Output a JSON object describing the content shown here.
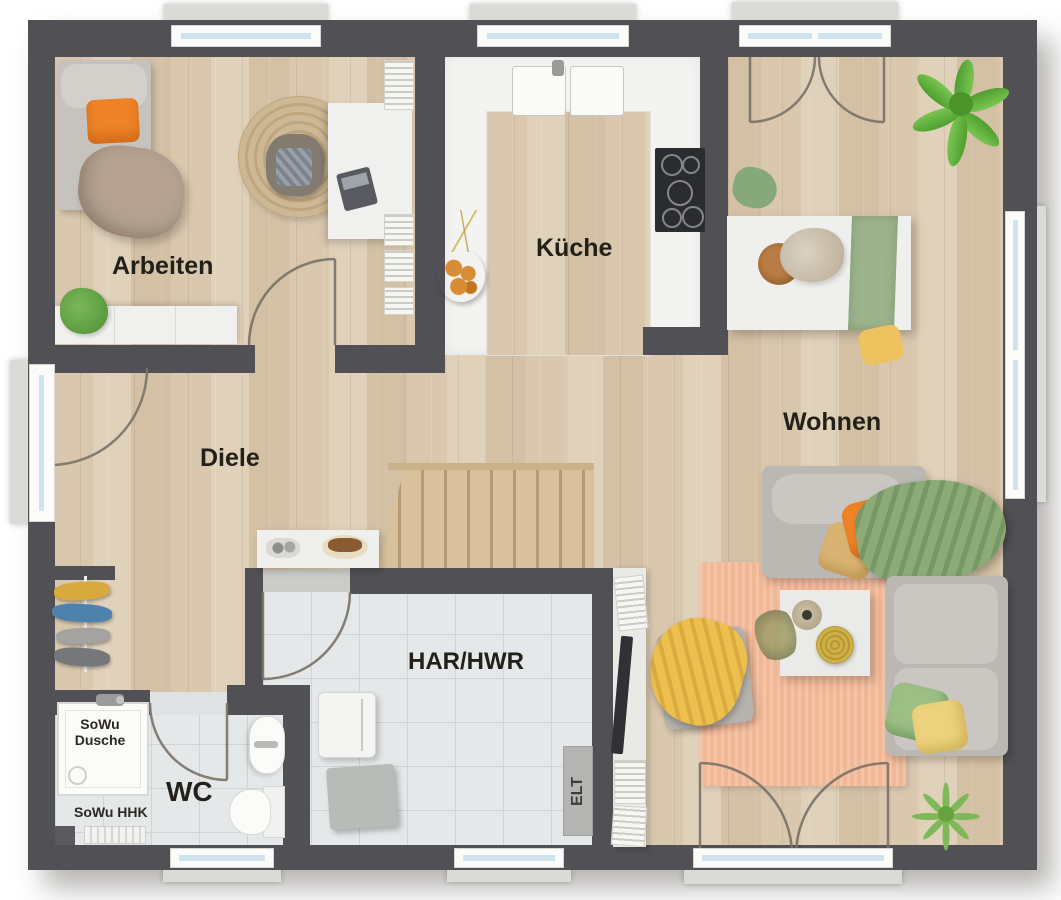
{
  "plan": {
    "type": "residential-floor-plan",
    "rooms": [
      {
        "id": "arbeiten",
        "label": "Arbeiten"
      },
      {
        "id": "kueche",
        "label": "Küche"
      },
      {
        "id": "wohnen",
        "label": "Wohnen"
      },
      {
        "id": "diele",
        "label": "Diele"
      },
      {
        "id": "har-hwr",
        "label": "HAR/HWR"
      },
      {
        "id": "wc",
        "label": "WC"
      }
    ],
    "annotations": {
      "shower_line1": "SoWu",
      "shower_line2": "Dusche",
      "heater": "SoWu HHK",
      "electrical": "ELT"
    },
    "palette": {
      "wall": "#515155",
      "wood_floor": "#d9c7ae",
      "tile_floor": "#e5e8e9",
      "kitchen_floor": "#f3f3f1",
      "stair_wood": "#d5bd97",
      "rug_peach": "#f2b795",
      "accent_orange": "#ee8327",
      "accent_yellow": "#eeb757",
      "accent_green": "#8cab77",
      "plant_green": "#6ab544",
      "window_glass": "#cfe3ee",
      "door_arc": "#7a7268",
      "label_text": "#232019"
    },
    "objects": [
      "bed",
      "round-rug",
      "desk",
      "desk-chair",
      "bookshelf",
      "sideboard",
      "houseplant",
      "kitchen-sink",
      "cooktop",
      "fruit-bowl",
      "dining-table",
      "table-runner",
      "dining-chairs",
      "fern-plant",
      "sofa",
      "chaise",
      "coffee-table",
      "ottoman",
      "area-rug",
      "tv-lowboard",
      "console-table",
      "coat-rack",
      "shower",
      "washbasin",
      "toilet",
      "towel-radiator",
      "washing-machine",
      "utility-box",
      "electrical-panel",
      "staircase",
      "grass-plant",
      "entrance-door",
      "french-door"
    ]
  }
}
